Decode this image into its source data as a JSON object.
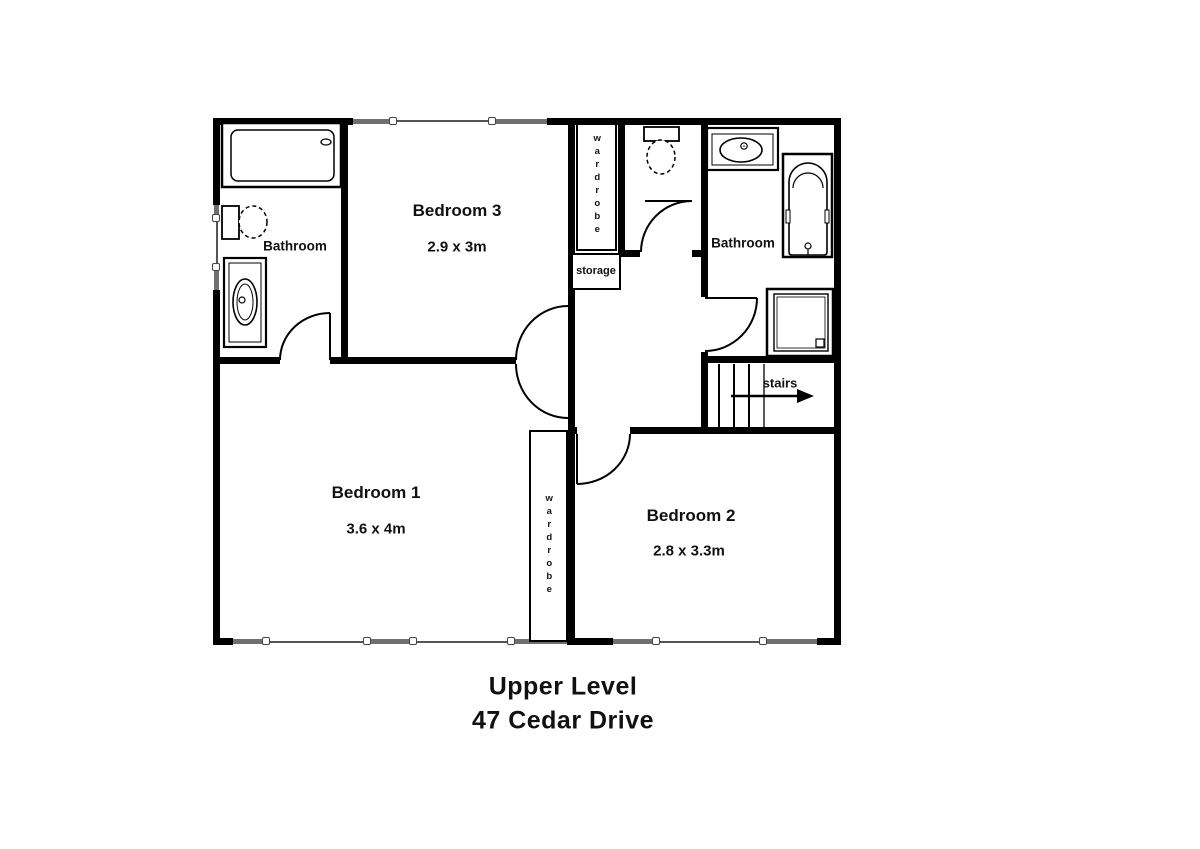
{
  "plan": {
    "title_line1": "Upper Level",
    "title_line2": "47 Cedar Drive"
  },
  "rooms": {
    "bedroom1": {
      "name": "Bedroom 1",
      "dims": "3.6 x 4m"
    },
    "bedroom2": {
      "name": "Bedroom 2",
      "dims": "2.8 x 3.3m"
    },
    "bedroom3": {
      "name": "Bedroom 3",
      "dims": "2.9 x 3m"
    },
    "bathroom_left": {
      "name": "Bathroom"
    },
    "bathroom_right": {
      "name": "Bathroom"
    }
  },
  "features": {
    "storage": "storage",
    "wardrobe_top": "wardrobe",
    "wardrobe_bedroom1": "wardrobe",
    "stairs": "stairs"
  },
  "colors": {
    "wall": "#000000",
    "window_sill": "#6f6f6f",
    "background": "#ffffff",
    "text": "#111111"
  }
}
